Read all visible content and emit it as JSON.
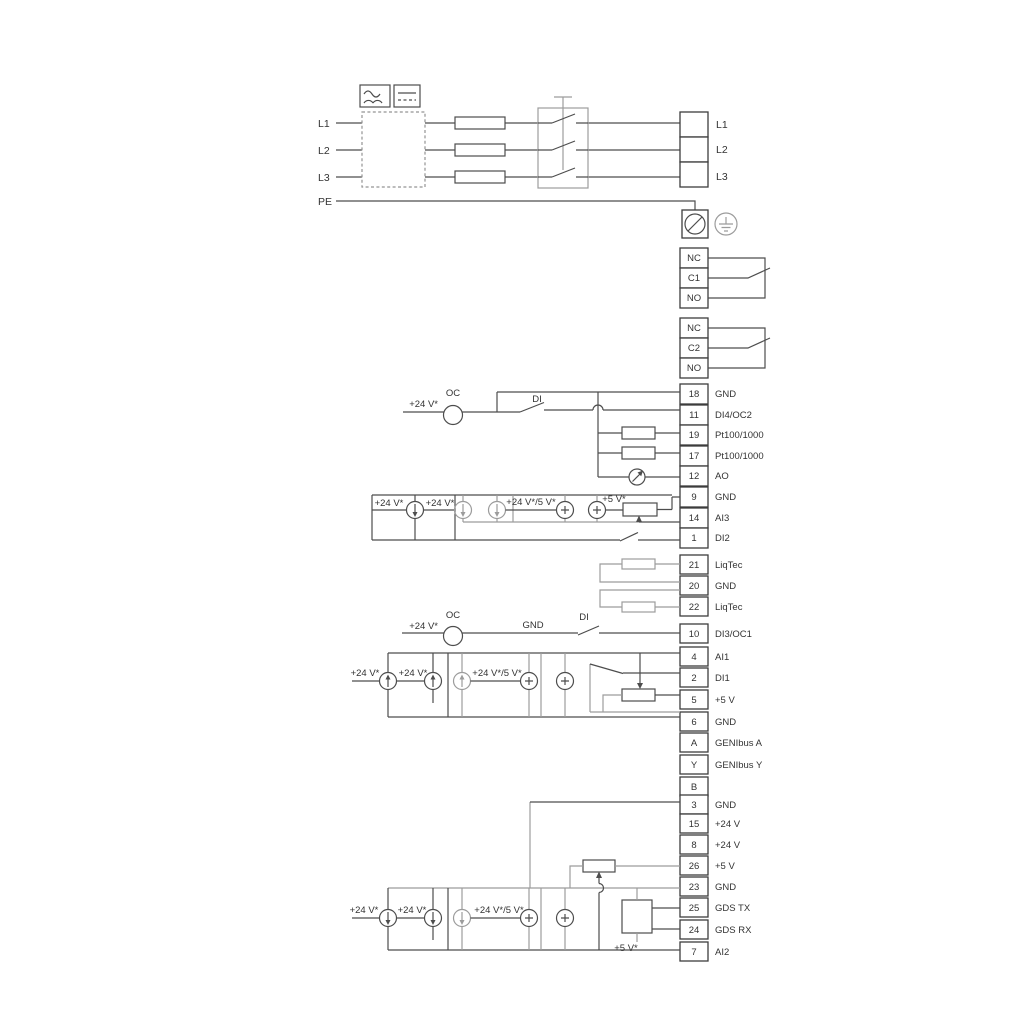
{
  "labels": {
    "v24": "+24 V*",
    "v24_5": "+24 V*/5 V*",
    "v5": "+5 V*",
    "oc": "OC",
    "di": "DI",
    "gnd": "GND"
  },
  "power": {
    "l1": "L1",
    "l2": "L2",
    "l3": "L3",
    "pe": "PE",
    "out": [
      "L1",
      "L2",
      "L3"
    ]
  },
  "relay1": [
    "NC",
    "C1",
    "NO"
  ],
  "relay2": [
    "NC",
    "C2",
    "NO"
  ],
  "strip1": [
    {
      "n": "18",
      "l": "GND"
    },
    {
      "n": "11",
      "l": "DI4/OC2"
    },
    {
      "n": "19",
      "l": "Pt100/1000"
    },
    {
      "n": "17",
      "l": "Pt100/1000"
    },
    {
      "n": "12",
      "l": "AO"
    },
    {
      "n": "9",
      "l": "GND"
    },
    {
      "n": "14",
      "l": "AI3"
    },
    {
      "n": "1",
      "l": "DI2"
    }
  ],
  "liqtec": [
    {
      "n": "21",
      "l": "LiqTec"
    },
    {
      "n": "20",
      "l": "GND"
    },
    {
      "n": "22",
      "l": "LiqTec"
    }
  ],
  "strip2": [
    {
      "n": "10",
      "l": "DI3/OC1"
    },
    {
      "n": "4",
      "l": "AI1"
    },
    {
      "n": "2",
      "l": "DI1"
    },
    {
      "n": "5",
      "l": "+5 V"
    },
    {
      "n": "6",
      "l": "GND"
    },
    {
      "n": "A",
      "l": "GENIbus A"
    },
    {
      "n": "Y",
      "l": "GENIbus Y"
    },
    {
      "n": "B",
      "l": "GENIbus B"
    }
  ],
  "strip3": [
    {
      "n": "3",
      "l": "GND"
    },
    {
      "n": "15",
      "l": "+24 V"
    },
    {
      "n": "8",
      "l": "+24 V"
    },
    {
      "n": "26",
      "l": "+5 V"
    },
    {
      "n": "23",
      "l": "GND"
    },
    {
      "n": "25",
      "l": "GDS TX"
    },
    {
      "n": "24",
      "l": "GDS RX"
    },
    {
      "n": "7",
      "l": "AI2"
    }
  ],
  "colors": {
    "wire": "#4d4d4d",
    "grey": "#9c9c9c",
    "text": "#333333",
    "background": "#ffffff"
  }
}
